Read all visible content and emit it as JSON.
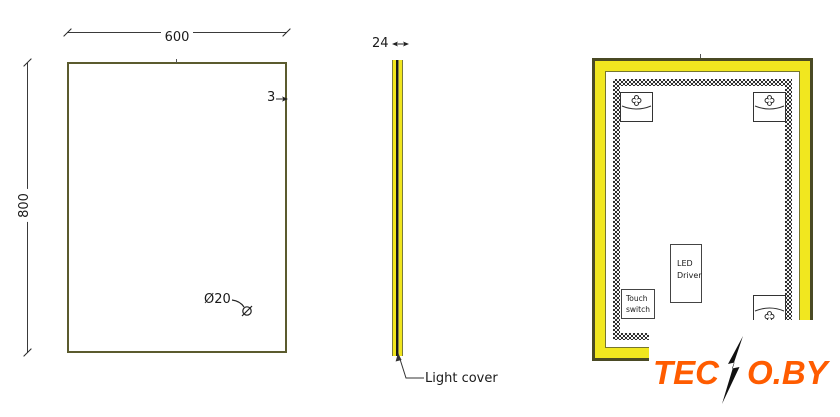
{
  "drawing": {
    "front_view": {
      "width_dim": "600",
      "height_dim": "800",
      "frame_thickness_dim": "3",
      "sensor_hole_dim": "Ø20"
    },
    "side_view": {
      "depth_dim": "24",
      "light_cover_label": "Light cover"
    },
    "back_view": {
      "led_driver_label": "LED Driver",
      "touch_switch_label": "Touch switch"
    },
    "watermark": {
      "logo_part1": "TEC",
      "logo_part2": "O.BY"
    }
  },
  "colors": {
    "line_olive": "#5b5b2e",
    "led_strip_yellow": "#f1e71f",
    "frame_dark_olive": "#4a4a24",
    "hatch_dark": "#2f2f2f",
    "logo_orange": "#ff5c00"
  }
}
